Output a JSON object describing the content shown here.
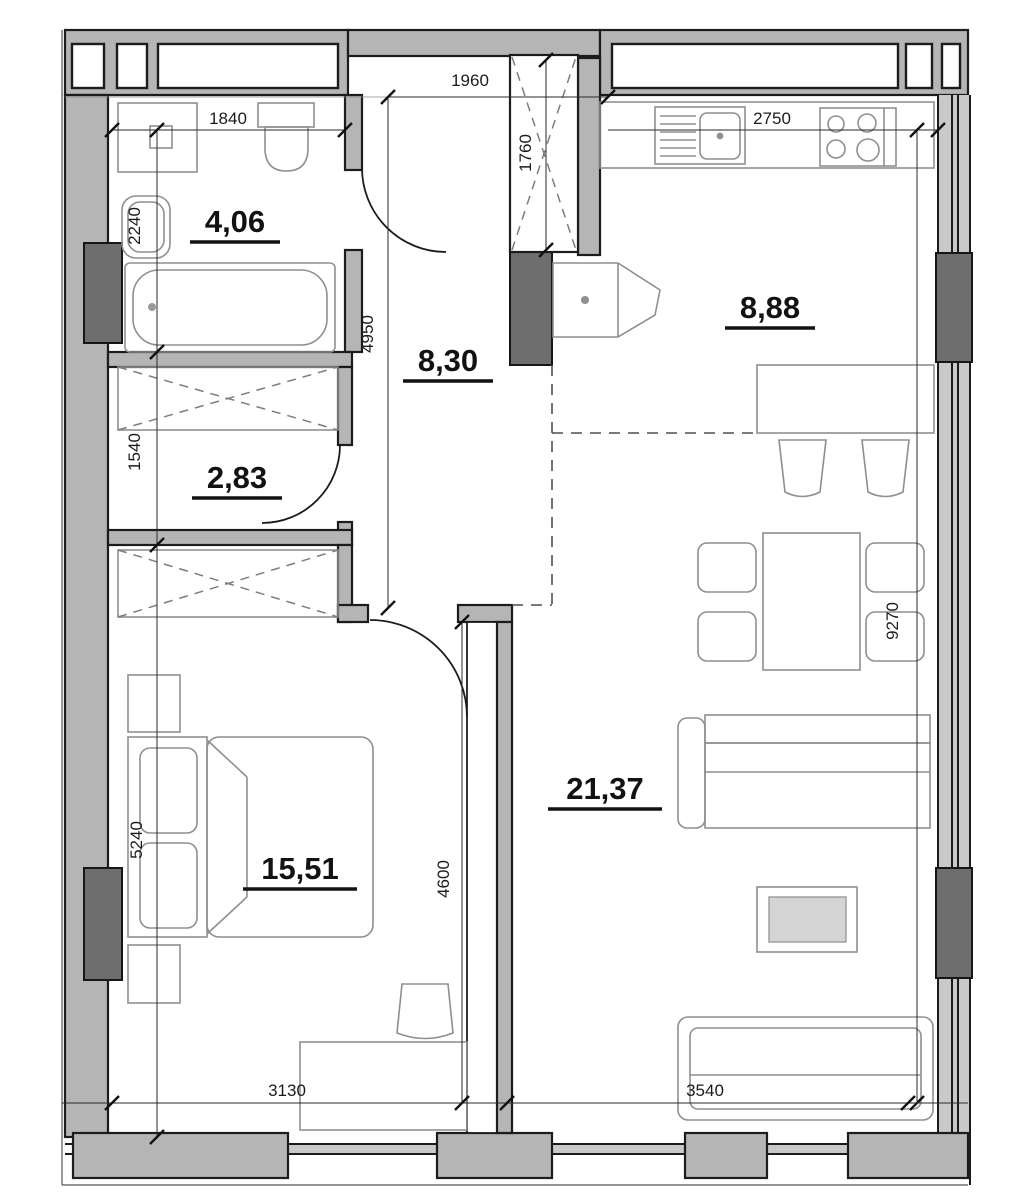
{
  "plan": {
    "type": "apartment-floor-plan",
    "rooms": [
      {
        "name": "bathroom",
        "area_label": "4,06"
      },
      {
        "name": "hallway",
        "area_label": "8,30"
      },
      {
        "name": "dressing-room",
        "area_label": "2,83"
      },
      {
        "name": "kitchen",
        "area_label": "8,88"
      },
      {
        "name": "bedroom",
        "area_label": "15,51"
      },
      {
        "name": "living-room",
        "area_label": "21,37"
      }
    ],
    "dimensions_mm": {
      "bathroom_width": "1840",
      "bathroom_depth": "2240",
      "entrance_niche_width": "1960",
      "hall_closet_depth": "1760",
      "kitchen_width": "2750",
      "hallway_length": "4950",
      "dressing_room_depth": "1540",
      "bedroom_depth": "5240",
      "bedroom_wall_length": "4600",
      "right_side_length": "9270",
      "bedroom_width": "3130",
      "living_room_width": "3540"
    },
    "colors": {
      "wall_fill": "#b5b5b5",
      "pillar_fill": "#6e6e6e",
      "outline": "#1c1c1c",
      "furniture_line": "#8f8f8f",
      "dimension_line": "#2a2a2a",
      "background": "#ffffff"
    }
  }
}
